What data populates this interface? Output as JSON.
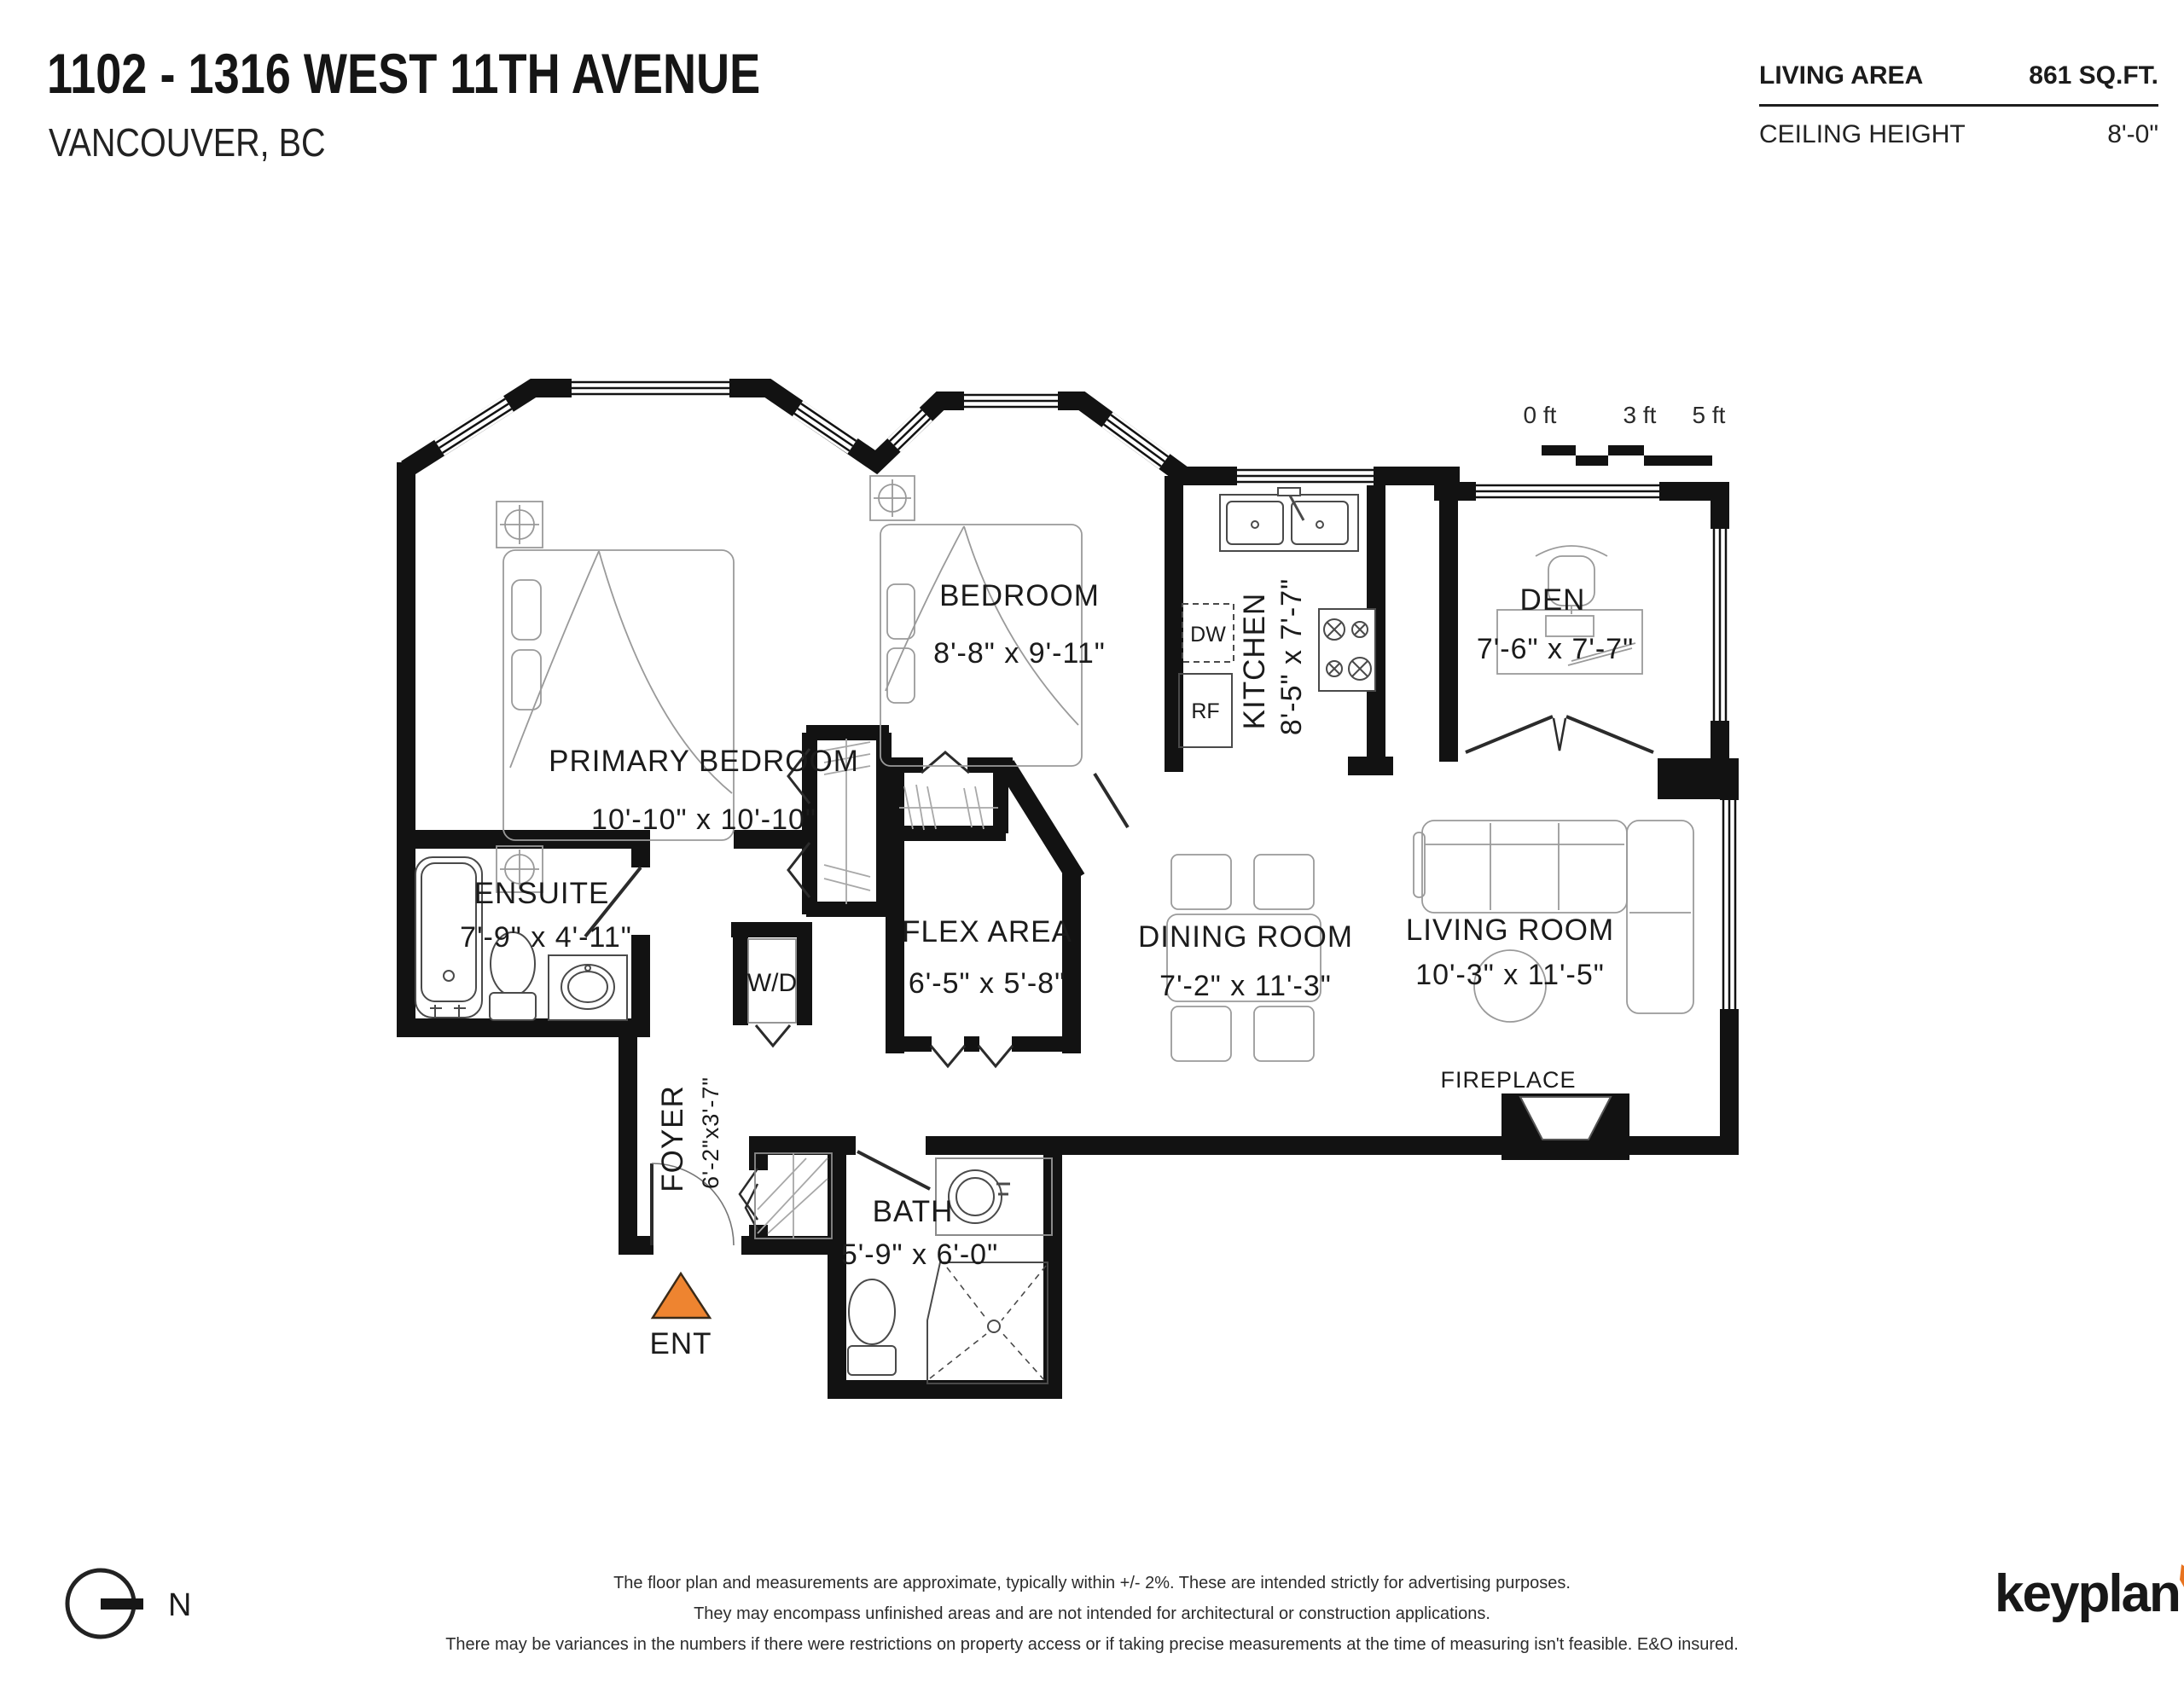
{
  "header": {
    "title": "1102 - 1316 WEST 11TH AVENUE",
    "subtitle": "VANCOUVER, BC"
  },
  "info": {
    "living_area_label": "LIVING AREA",
    "living_area_value": "861 SQ.FT.",
    "ceiling_label": "CEILING HEIGHT",
    "ceiling_value": "8'-0\""
  },
  "scale_bar": {
    "tick0": "0 ft",
    "tick1": "3 ft",
    "tick2": "5 ft"
  },
  "rooms": {
    "primary_bedroom": {
      "name": "PRIMARY BEDROOM",
      "dims": "10'-10\" x 10'-10\""
    },
    "bedroom": {
      "name": "BEDROOM",
      "dims": "8'-8\"  x  9'-11\""
    },
    "kitchen": {
      "name": "KITCHEN",
      "dims": "8'-5\"  x  7'-7\""
    },
    "den": {
      "name": "DEN",
      "dims": "7'-6\"  x  7'-7\""
    },
    "ensuite": {
      "name": "ENSUITE",
      "dims": "7'-9\" x 4'-11\""
    },
    "flex_area": {
      "name": "FLEX AREA",
      "dims": "6'-5\"  x  5'-8\""
    },
    "dining_room": {
      "name": "DINING ROOM",
      "dims": "7'-2\"  x  11'-3\""
    },
    "living_room": {
      "name": "LIVING ROOM",
      "dims": "10'-3\" x  11'-5\""
    },
    "foyer": {
      "name": "FOYER",
      "dims": "6'-2\"x3'-7\""
    },
    "bath": {
      "name": "BATH",
      "dims": "5'-9\" x 6'-0\""
    },
    "wd_label": "W/D",
    "dw_label": "DW",
    "rf_label": "RF",
    "fireplace_label": "FIREPLACE",
    "entry_label": "ENT"
  },
  "compass": {
    "north_label": "N"
  },
  "footer": {
    "line1": "The floor plan and measurements are approximate, typically within +/- 2%. These are intended strictly for advertising purposes.",
    "line2": "They may encompass unfinished areas and are not intended for architectural or construction applications.",
    "line3": "There may be variances in the numbers if there were restrictions on property access or if taking precise measurements at the time of measuring isn't feasible. E&O insured."
  },
  "brand": {
    "logo_text": "keyplan"
  },
  "colors": {
    "wall": "#121212",
    "accent_orange": "#EE8430",
    "furniture": "#9a9a9a"
  }
}
